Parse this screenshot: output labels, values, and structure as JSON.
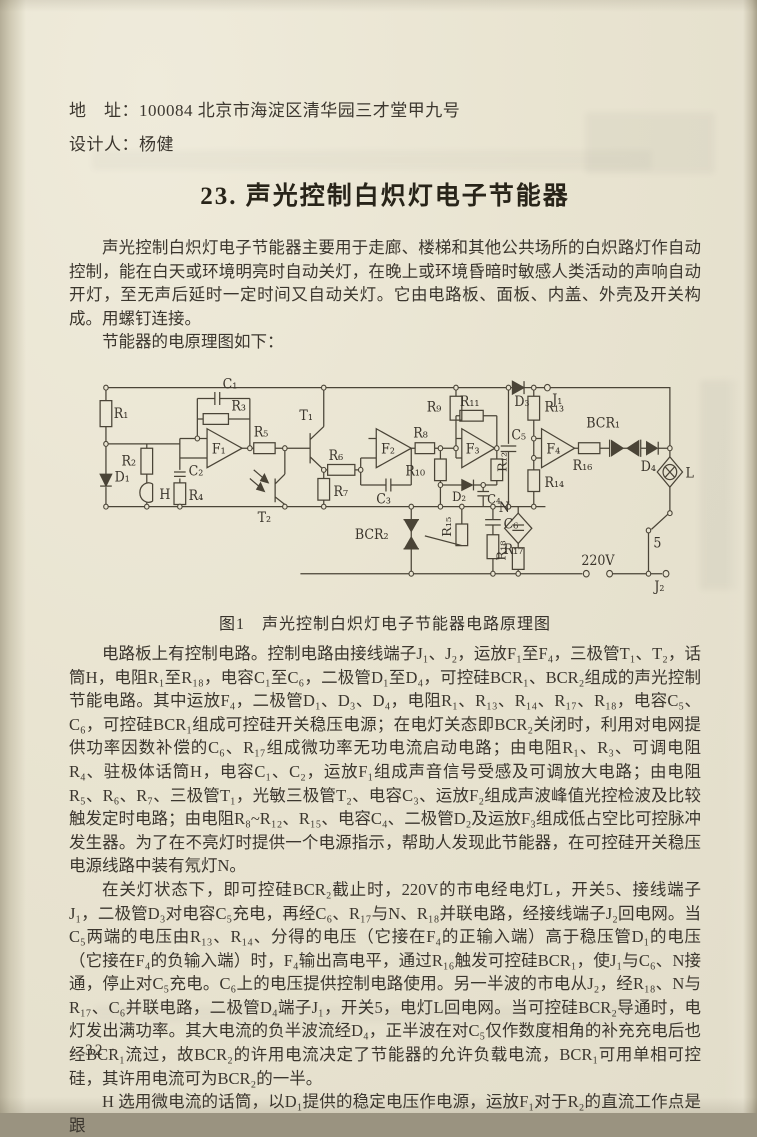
{
  "header": {
    "address_line": "地　址：100084 北京市海淀区清华园三才堂甲九号",
    "designer_line": "设计人：杨健"
  },
  "title": "23. 声光控制白炽灯电子节能器",
  "paragraphs": {
    "intro": "声光控制白炽灯电子节能器主要用于走廊、楼梯和其他公共场所的白炽路灯作自动控制，能在白天或环境明亮时自动关灯，在晚上或环境昏暗时敏感人类活动的声响自动开灯，至无声后延时一定时间又自动关灯。它由电路板、面板、内盖、外壳及开关构成。用螺钉连接。",
    "lead_in": "节能器的电原理图如下：",
    "p2": "电路板上有控制电路。控制电路由接线端子J₁、J₂，运放F₁至F₄，三极管T₁、T₂，话筒H，电阻R₁至R₁₈，电容C₁至C₆，二极管D₁至D₄，可控硅BCR₁、BCR₂组成的声光控制节能电路。其中运放F₄，二极管D₁、D₃、D₄，电阻R₁、R₁₃、R₁₄、R₁₇、R₁₈，电容C₅、C₆，可控硅BCR₁组成可控硅开关稳压电源；在电灯关态即BCR₂关闭时，利用对电网提供功率因数补偿的C₆、R₁₇组成微功率无功电流启动电路；由电阻R₁、R₃、可调电阻R₄、驻极体话筒H，电容C₁、C₂，运放F₁组成声音信号受感及可调放大电路；由电阻R₅、R₆、R₇、三极管T₁，光敏三极管T₂、电容C₃、运放F₂组成声波峰值光控检波及比较触发定时电路；由电阻R₈~R₁₂、R₁₅、电容C₄、二极管D₂及运放F₃组成低占空比可控脉冲发生器。为了在不亮灯时提供一个电源指示，帮助人发现此节能器，在可控硅开关稳压电源线路中装有氖灯N。",
    "p3": "在关灯状态下，即可控硅BCR₂截止时，220V的市电经电灯L，开关5、接线端子J₁，二极管D₃对电容C₅充电，再经C₆、R₁₇与N、R₁₈并联电路，经接线端子J₂回电网。当C₅两端的电压由R₁₃、R₁₄、分得的电压（它接在F₄的正输入端）高于稳压管D₁的电压（它接在F₄的负输入端）时，F₄输出高电平，通过R₁₆触发可控硅BCR₁，使J₁与C₆、N接通，停止对C₅充电。C₆上的电压提供控制电路使用。另一半波的市电从J₂，经R₁₈、N与R₁₇、C₆并联电路，二极管D₄端子J₁，开关5，电灯L回电网。当可控硅BCR₂导通时，电灯发出满功率。其大电流的负半波流经D₄，正半波在对C₅仅作数度相角的补充充电后也经BCR₁流过，故BCR₂的许用电流决定了节能器的允许负载电流，BCR₁可用单相可控硅，其许用电流可为BCR₂的一半。",
    "p4": "H 选用微电流的话筒，以D₁提供的稳定电压作电源，运放F₁对于R₂的直流工作点是跟"
  },
  "figure": {
    "caption": "图1　声光控制白炽灯电子节能器电路原理图",
    "labels": {
      "r1": "R₁",
      "r2": "R₂",
      "r3": "R₃",
      "r4": "R₄",
      "r5": "R₅",
      "r6": "R₆",
      "r7": "R₇",
      "r8": "R₈",
      "r9": "R₉",
      "r10": "R₁₀",
      "r11": "R₁₁",
      "r12": "R₁₂",
      "r13": "R₁₃",
      "r14": "R₁₄",
      "r15": "R₁₅",
      "r16": "R₁₆",
      "r17": "R₁₇",
      "r18": "R₁₈",
      "c1": "C₁",
      "c2": "C₂",
      "c3": "C₃",
      "c4": "C₄",
      "c5": "C₅",
      "c6": "C₆",
      "d1": "D₁",
      "d2": "D₂",
      "d3": "D₃",
      "d4": "D₄",
      "t1": "T₁",
      "t2": "T₂",
      "f1": "F₁",
      "f2": "F₂",
      "f3": "F₃",
      "f4": "F₄",
      "bcr1": "BCR₁",
      "bcr2": "BCR₂",
      "h": "H",
      "n": "N",
      "l": "L",
      "j1": "J₁",
      "j2": "J₂",
      "sw": "5",
      "v220": "220V"
    }
  },
  "footer": {
    "page_number": "· 32 ·"
  }
}
